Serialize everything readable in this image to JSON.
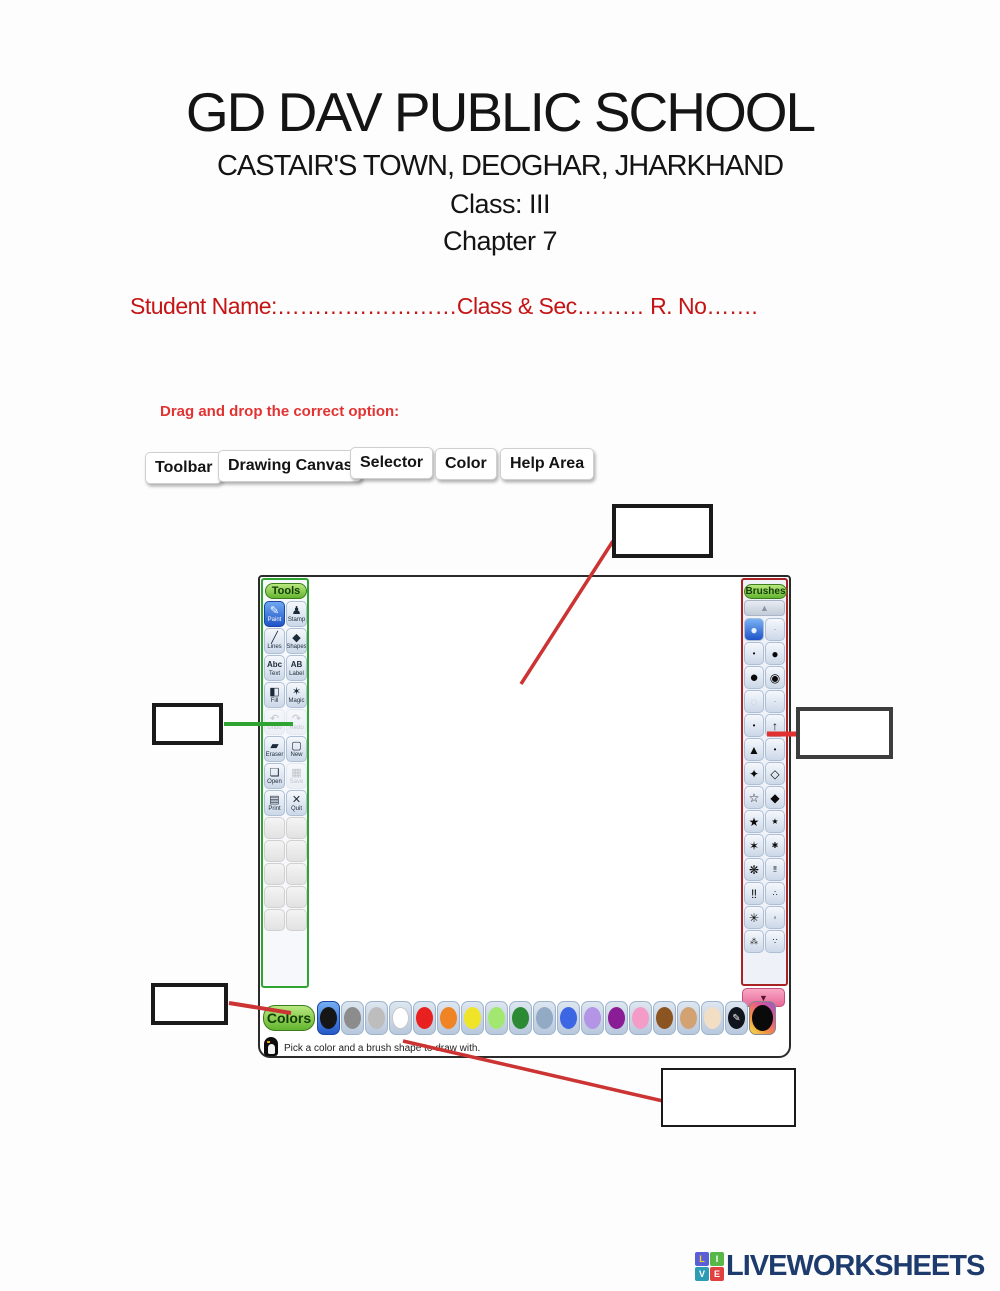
{
  "colors": {
    "accent_red": "#cc2222",
    "accent_green": "#2fa433",
    "annotation_dark_red": "#a82424",
    "header_red": "#c41414",
    "logo_navy": "#1e3b6e"
  },
  "header": {
    "school": "GD DAV PUBLIC SCHOOL",
    "address": "CASTAIR'S TOWN, DEOGHAR, JHARKHAND",
    "class_line": "Class: III",
    "chapter_line": "Chapter 7",
    "student_line": "Student Name:……………………Class & Sec……… R. No……."
  },
  "exercise": {
    "instruction": "Drag and drop the correct option:",
    "options": [
      "Toolbar",
      "Drawing Canvas",
      "Selector",
      "Color",
      "Help Area"
    ]
  },
  "tuxpaint": {
    "tools_title": "Tools",
    "brushes_title": "Brushes",
    "colors_title": "Colors",
    "help_text": "Pick a color and a brush shape to draw with.",
    "tools": [
      {
        "label": "Paint",
        "icon": "paintbrush-icon",
        "glyph": "✎",
        "selected": true
      },
      {
        "label": "Stamp",
        "icon": "stamp-icon",
        "glyph": "♟"
      },
      {
        "label": "Lines",
        "icon": "lines-icon",
        "glyph": "╱"
      },
      {
        "label": "Shapes",
        "icon": "shapes-icon",
        "glyph": "◆"
      },
      {
        "label": "Text",
        "icon": "text-icon",
        "glyph": "Abc",
        "text_glyph": true
      },
      {
        "label": "Label",
        "icon": "label-icon",
        "glyph": "AB",
        "text_glyph": true
      },
      {
        "label": "Fill",
        "icon": "fill-icon",
        "glyph": "◧"
      },
      {
        "label": "Magic",
        "icon": "magic-icon",
        "glyph": "✶"
      },
      {
        "label": "Undo",
        "icon": "undo-icon",
        "glyph": "↶",
        "disabled": true
      },
      {
        "label": "Redo",
        "icon": "redo-icon",
        "glyph": "↷",
        "disabled": true
      },
      {
        "label": "Eraser",
        "icon": "eraser-icon",
        "glyph": "▰"
      },
      {
        "label": "New",
        "icon": "new-icon",
        "glyph": "▢"
      },
      {
        "label": "Open",
        "icon": "open-icon",
        "glyph": "❏"
      },
      {
        "label": "Save",
        "icon": "save-icon",
        "glyph": "▦",
        "disabled": true
      },
      {
        "label": "Print",
        "icon": "print-icon",
        "glyph": "▤"
      },
      {
        "label": "Quit",
        "icon": "quit-icon",
        "glyph": "✕"
      }
    ],
    "empty_tool_slots": 10,
    "brush_scroll_up_glyph": "▲",
    "brush_scroll_down_glyph": "▼",
    "brushes": [
      {
        "glyph": "●",
        "name": "round-brush",
        "selected": true
      },
      {
        "glyph": "·",
        "name": "tiny-dot-brush",
        "size": "xs"
      },
      {
        "glyph": "•",
        "name": "small-dot-brush",
        "size": "sm"
      },
      {
        "glyph": "●",
        "name": "dot-brush"
      },
      {
        "glyph": "●",
        "name": "large-circle-brush",
        "size": "lg"
      },
      {
        "glyph": "◉",
        "name": "ring-dot-brush"
      },
      {
        "glyph": "◌",
        "name": "fuzzy-circle-brush",
        "size": "ghost"
      },
      {
        "glyph": "·",
        "name": "tiny-dot-brush",
        "size": "xs"
      },
      {
        "glyph": "•",
        "name": "small-dot-brush",
        "size": "sm"
      },
      {
        "glyph": "↑",
        "name": "arrow-brush"
      },
      {
        "glyph": "▲",
        "name": "triangle-brush"
      },
      {
        "glyph": "•",
        "name": "small-dot-brush",
        "size": "sm"
      },
      {
        "glyph": "✦",
        "name": "blob-brush"
      },
      {
        "glyph": "◇",
        "name": "pentagon-brush"
      },
      {
        "glyph": "☆",
        "name": "star-outline-brush"
      },
      {
        "glyph": "◆",
        "name": "diamond-brush"
      },
      {
        "glyph": "★",
        "name": "star-brush"
      },
      {
        "glyph": "★",
        "name": "small-star-brush",
        "size": "sm"
      },
      {
        "glyph": "✶",
        "name": "six-point-star-brush"
      },
      {
        "glyph": "✱",
        "name": "asterisk-brush",
        "size": "sm"
      },
      {
        "glyph": "❋",
        "name": "flower-brush"
      },
      {
        "glyph": "‼",
        "name": "footprints-brush",
        "size": "sm"
      },
      {
        "glyph": "‼",
        "name": "footprints-brush"
      },
      {
        "glyph": "∴",
        "name": "paw-prints-brush",
        "size": "sm"
      },
      {
        "glyph": "✳",
        "name": "splat-brush"
      },
      {
        "glyph": "◦",
        "name": "hollow-dot-brush",
        "size": "sm"
      },
      {
        "glyph": "⁂",
        "name": "scatter-brush",
        "size": "sm"
      },
      {
        "glyph": "∵",
        "name": "dots-brush",
        "size": "sm"
      }
    ],
    "palette": [
      {
        "name": "black",
        "hex": "#161616",
        "selected": true
      },
      {
        "name": "gray",
        "hex": "#8c8c8c"
      },
      {
        "name": "silver",
        "hex": "#bdbdbd"
      },
      {
        "name": "white",
        "hex": "#ffffff"
      },
      {
        "name": "red",
        "hex": "#e82020"
      },
      {
        "name": "orange",
        "hex": "#f08424"
      },
      {
        "name": "yellow",
        "hex": "#f0e428"
      },
      {
        "name": "light-green",
        "hex": "#a2e870"
      },
      {
        "name": "green",
        "hex": "#2c8a34"
      },
      {
        "name": "gray-blue",
        "hex": "#92aac4"
      },
      {
        "name": "blue",
        "hex": "#3c66e4"
      },
      {
        "name": "lavender",
        "hex": "#b494e4"
      },
      {
        "name": "purple",
        "hex": "#8a1c96"
      },
      {
        "name": "pink",
        "hex": "#f49cc8"
      },
      {
        "name": "brown",
        "hex": "#8c5420"
      },
      {
        "name": "tan",
        "hex": "#d2a272"
      },
      {
        "name": "beige",
        "hex": "#f2dec4"
      },
      {
        "name": "rainbow-picker",
        "type": "picker",
        "glyph": "✎"
      },
      {
        "name": "current-color",
        "type": "well"
      }
    ]
  },
  "logo": {
    "text": "LIVEWORKSHEETS",
    "blocks": [
      {
        "letter": "L",
        "bg": "#5b5fd6",
        "fg": "#f5d327"
      },
      {
        "letter": "I",
        "bg": "#58b847",
        "fg": "#ffffff"
      },
      {
        "letter": "V",
        "bg": "#2e9bb5",
        "fg": "#ffffff"
      },
      {
        "letter": "E",
        "bg": "#e04040",
        "fg": "#ffffff"
      }
    ]
  }
}
